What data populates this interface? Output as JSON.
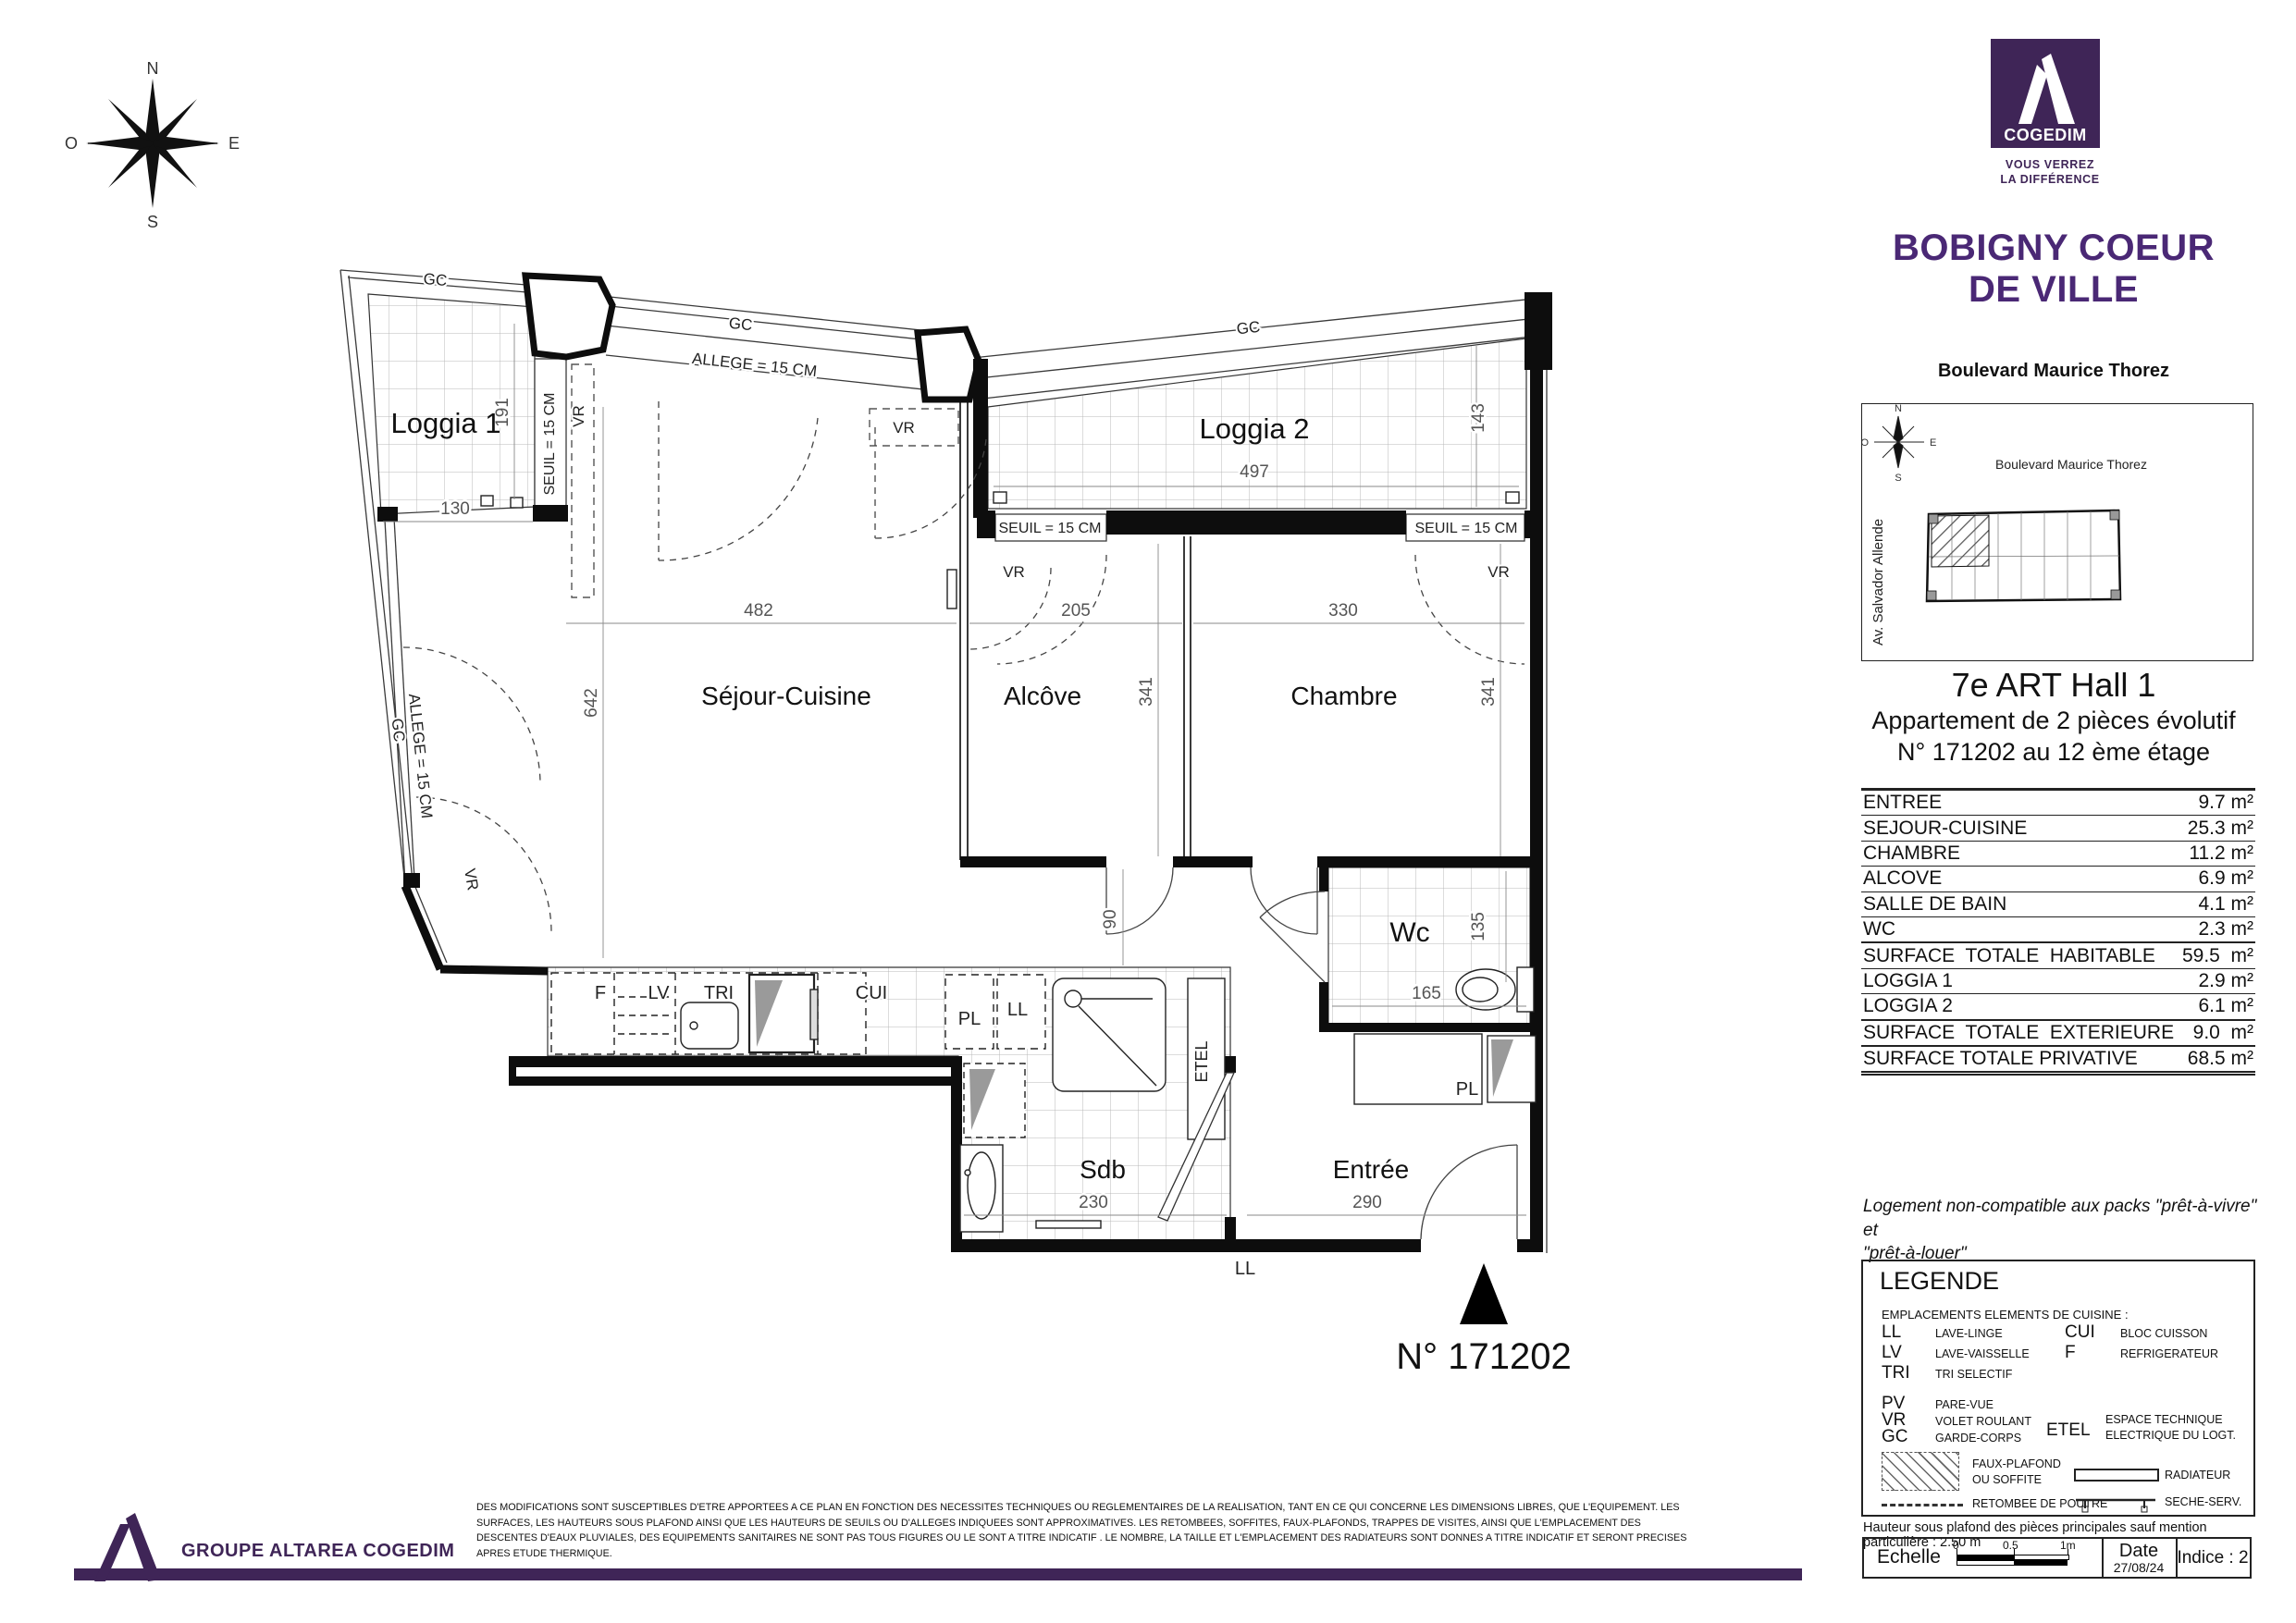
{
  "colors": {
    "brand_purple": "#3F2557",
    "title_purple": "#4A2875"
  },
  "compass": {
    "n": "N",
    "e": "E",
    "s": "S",
    "o": "O"
  },
  "logo": {
    "name": "COGEDIM",
    "tagline1": "VOUS VERREZ",
    "tagline2": "LA DIFFÉRENCE"
  },
  "project": {
    "title1": "BOBIGNY COEUR",
    "title2": "DE VILLE",
    "address": "Boulevard Maurice Thorez"
  },
  "site_map": {
    "street_top": "Boulevard Maurice Thorez",
    "street_left": "Av. Salvador Allende"
  },
  "unit": {
    "hall": "7e ART Hall 1",
    "description": "Appartement de 2 pièces évolutif",
    "location": "N° 171202 au 12 ème étage",
    "number": "N° 171202"
  },
  "surfaces": {
    "rows": [
      {
        "label": "ENTREE",
        "value": "9.7 m²"
      },
      {
        "label": "SEJOUR-CUISINE",
        "value": "25.3 m²"
      },
      {
        "label": "CHAMBRE",
        "value": "11.2 m²"
      },
      {
        "label": "ALCOVE",
        "value": "6.9 m²"
      },
      {
        "label": "SALLE DE BAIN",
        "value": "4.1 m²"
      },
      {
        "label": "WC",
        "value": "2.3 m²"
      },
      {
        "label": "SURFACE  TOTALE  HABITABLE",
        "value": "59.5  m²"
      },
      {
        "label": "LOGGIA 1",
        "value": "2.9 m²"
      },
      {
        "label": "LOGGIA 2",
        "value": "6.1 m²"
      },
      {
        "label": "SURFACE  TOTALE  EXTERIEURE",
        "value": "9.0  m²"
      },
      {
        "label": "SURFACE TOTALE PRIVATIVE",
        "value": "68.5 m²"
      }
    ]
  },
  "notice": {
    "line1": "Logement non-compatible aux packs \"prêt-à-vivre\" et",
    "line2": "\"prêt-à-louer\""
  },
  "plan": {
    "rooms": {
      "loggia1": "Loggia 1",
      "loggia2": "Loggia 2",
      "sejour": "Séjour-Cuisine",
      "alcove": "Alcôve",
      "chambre": "Chambre",
      "wc": "Wc",
      "sdb": "Sdb",
      "entree": "Entrée"
    },
    "dims": {
      "loggia1_w": "130",
      "loggia1_h": "191",
      "sejour_w": "482",
      "sejour_h": "642",
      "alcove_w": "205",
      "alcove_h": "341",
      "chambre_w": "330",
      "chambre_h": "341",
      "loggia2_w": "497",
      "loggia2_h": "143",
      "passage_h": "90",
      "wc_h": "135",
      "wc_w": "165",
      "sdb_w": "230",
      "entree_w": "290"
    },
    "labels": {
      "gc": "GC",
      "vr": "VR",
      "allege": "ALLEGE = 15 CM",
      "seuil": "SEUIL = 15 CM",
      "f": "F",
      "lv": "LV",
      "tri": "TRI",
      "cui": "CUI",
      "pl": "PL",
      "ll": "LL",
      "etel": "ETEL"
    }
  },
  "legend": {
    "title": "LEGENDE",
    "kitchen_header": "EMPLACEMENTS ELEMENTS DE CUISINE :",
    "ll_abbr": "LL",
    "ll": "LAVE-LINGE",
    "lv_abbr": "LV",
    "lv": "LAVE-VAISSELLE",
    "tri_abbr": "TRI",
    "tri": "TRI SELECTIF",
    "cui_abbr": "CUI",
    "cui": "BLOC CUISSON",
    "f_abbr": "F",
    "f": "REFRIGERATEUR",
    "pv_abbr": "PV",
    "pv": "PARE-VUE",
    "vr_abbr": "VR",
    "vr": "VOLET ROULANT",
    "gc_abbr": "GC",
    "gc": "GARDE-CORPS",
    "etel_abbr": "ETEL",
    "etel1": "ESPACE TECHNIQUE",
    "etel2": "ELECTRIQUE DU LOGT.",
    "faux1": "FAUX-PLAFOND",
    "faux2": "OU SOFFITE",
    "radiateur": "RADIATEUR",
    "retombee": "RETOMBEE DE POUTRE",
    "seche": "SECHE-SERV."
  },
  "ceiling_note": "Hauteur sous plafond des pièces principales sauf mention particulière : 2.50 m",
  "title_block": {
    "echelle": "Echelle",
    "t0": "0",
    "t05": "0.5",
    "t1": "1m",
    "date_label": "Date",
    "date": "27/08/24",
    "indice": "Indice : 2"
  },
  "footer": {
    "company": "GROUPE ALTAREA COGEDIM",
    "disclaimer_lines": [
      "DES MODIFICATIONS SONT SUSCEPTIBLES D'ETRE APPORTEES A CE PLAN EN FONCTION DES NECESSITES TECHNIQUES OU REGLEMENTAIRES DE LA REALISATION, TANT EN CE QUI CONCERNE LES DIMENSIONS LIBRES, QUE L'EQUIPEMENT. LES",
      "SURFACES, LES HAUTEURS SOUS PLAFOND AINSI QUE LES HAUTEURS DE SEUILS OU D'ALLEGES INDIQUEES SONT APPROXIMATIVES. LES RETOMBEES, SOFFITES, FAUX-PLAFONDS, TRAPPES DE VISITES, AINSI QUE L'EMPLACEMENT DES",
      "DESCENTES D'EAUX PLUVIALES, DES EQUIPEMENTS SANITAIRES NE SONT PAS TOUS FIGURES OU LE SONT A TITRE INDICATIF . LE NOMBRE, LA TAILLE ET L'EMPLACEMENT DES RADIATEURS SONT DONNES A TITRE INDICATIF ET SERONT PRECISES",
      "APRES ETUDE THERMIQUE."
    ]
  }
}
